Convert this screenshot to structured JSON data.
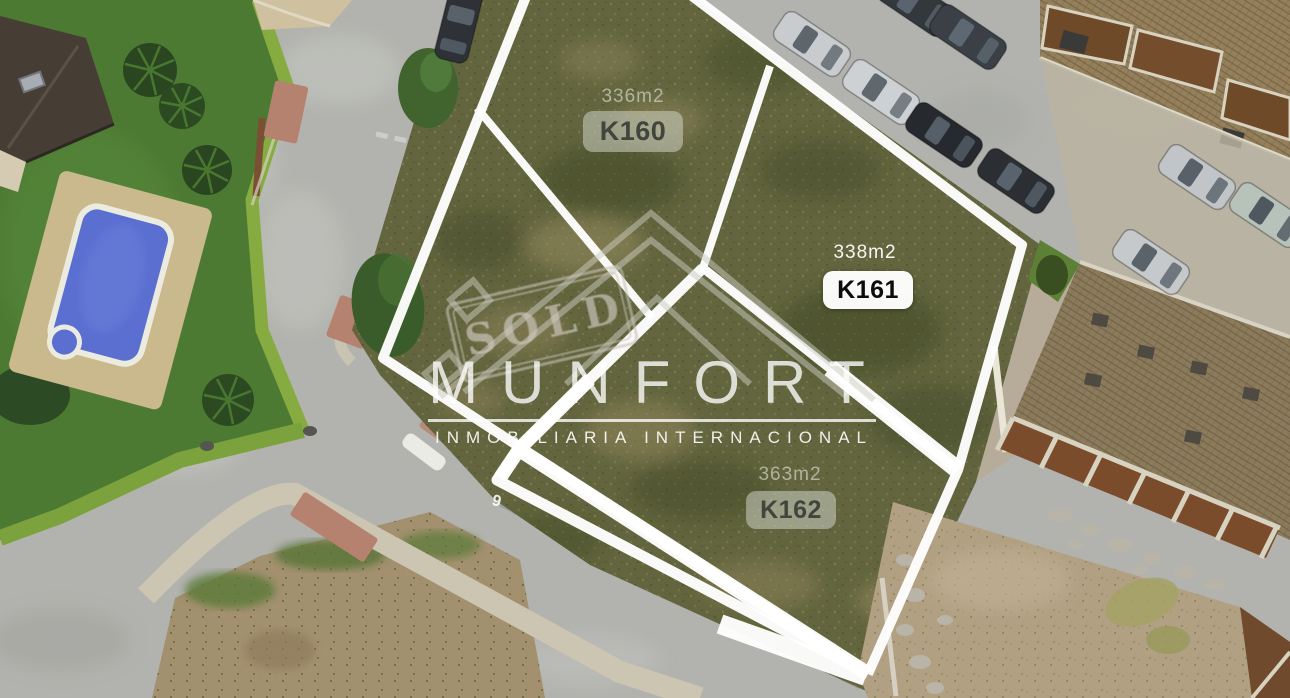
{
  "scene": {
    "description": "Aerial view of four marked building plots beside residential streets"
  },
  "plots": [
    {
      "code": "K160",
      "area": "336m2",
      "chip_style": "translucent"
    },
    {
      "code": "K161",
      "area": "338m2",
      "chip_style": "white"
    },
    {
      "code": "K162",
      "area": "363m2",
      "chip_style": "translucent"
    }
  ],
  "watermark": {
    "brand": "MUNFORT",
    "tagline": "INMOBILIARIA INTERNACIONAL",
    "stamp": "SOLD"
  },
  "road": {
    "pavement_number": "9"
  },
  "colors": {
    "plot_line": "#ffffff",
    "plot_grass": "#62653e",
    "road": "#b2b3ae",
    "pool_water": "#5a6fd0",
    "sold_chip_bg": "rgba(206,210,197,0.55)",
    "available_chip_bg": "#ffffff",
    "brand_text": "rgba(255,255,255,0.78)"
  }
}
